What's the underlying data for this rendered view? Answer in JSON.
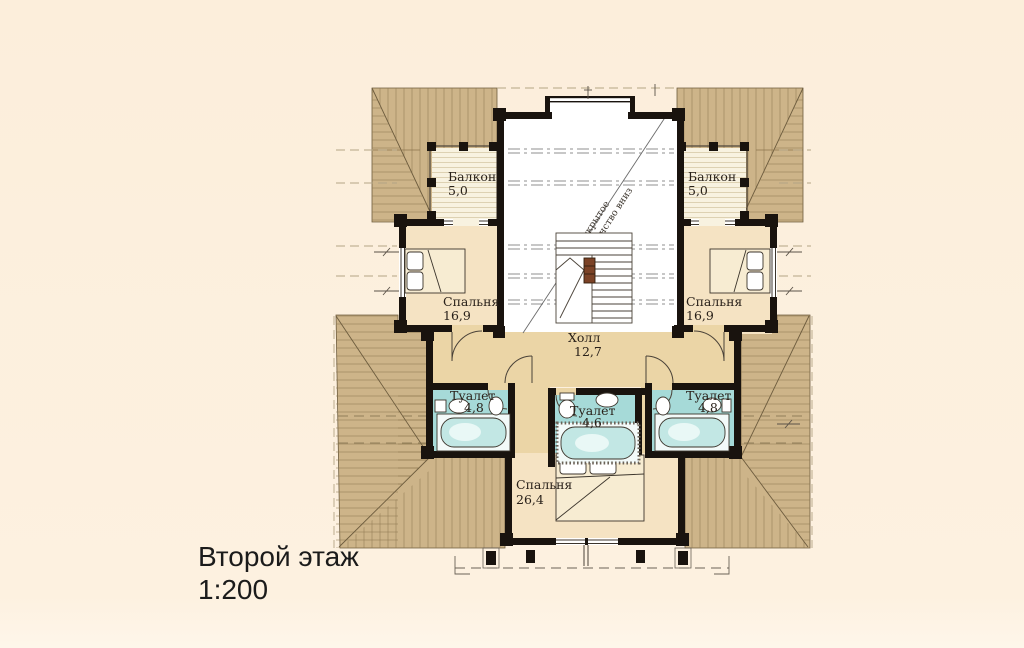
{
  "title": {
    "line1": "Второй этаж",
    "line2": "1:200"
  },
  "plan": {
    "rooms": [
      {
        "id": "balcony-left",
        "name": "Балкон",
        "area": "5,0"
      },
      {
        "id": "balcony-right",
        "name": "Балкон",
        "area": "5,0"
      },
      {
        "id": "bedroom-left",
        "name": "Спальня",
        "area": "16,9"
      },
      {
        "id": "bedroom-right",
        "name": "Спальня",
        "area": "16,9"
      },
      {
        "id": "hall",
        "name": "Холл",
        "area": "12,7"
      },
      {
        "id": "toilet-left",
        "name": "Туалет",
        "area": "4,8"
      },
      {
        "id": "toilet-center",
        "name": "Туалет",
        "area": "4,6"
      },
      {
        "id": "toilet-right",
        "name": "Туалет",
        "area": "4,8"
      },
      {
        "id": "bedroom-bottom",
        "name": "Спальня",
        "area": "26,4"
      }
    ],
    "annotations": {
      "open_space_line1": "открытое",
      "open_space_line2": "пространство вниз"
    },
    "colors": {
      "background": "#fceedb",
      "roof": "#cdb489",
      "roof_line": "#8c764e",
      "wall": "#19130e",
      "room_floor": "#f5e3c3",
      "hall_floor": "#ebd5a6",
      "toilet_floor": "#a6dad8",
      "tub_water": "#c2e7e4",
      "balcony_deck": "#f8f2e0",
      "open_space": "#ffffff",
      "label_text": "#29211a"
    }
  }
}
